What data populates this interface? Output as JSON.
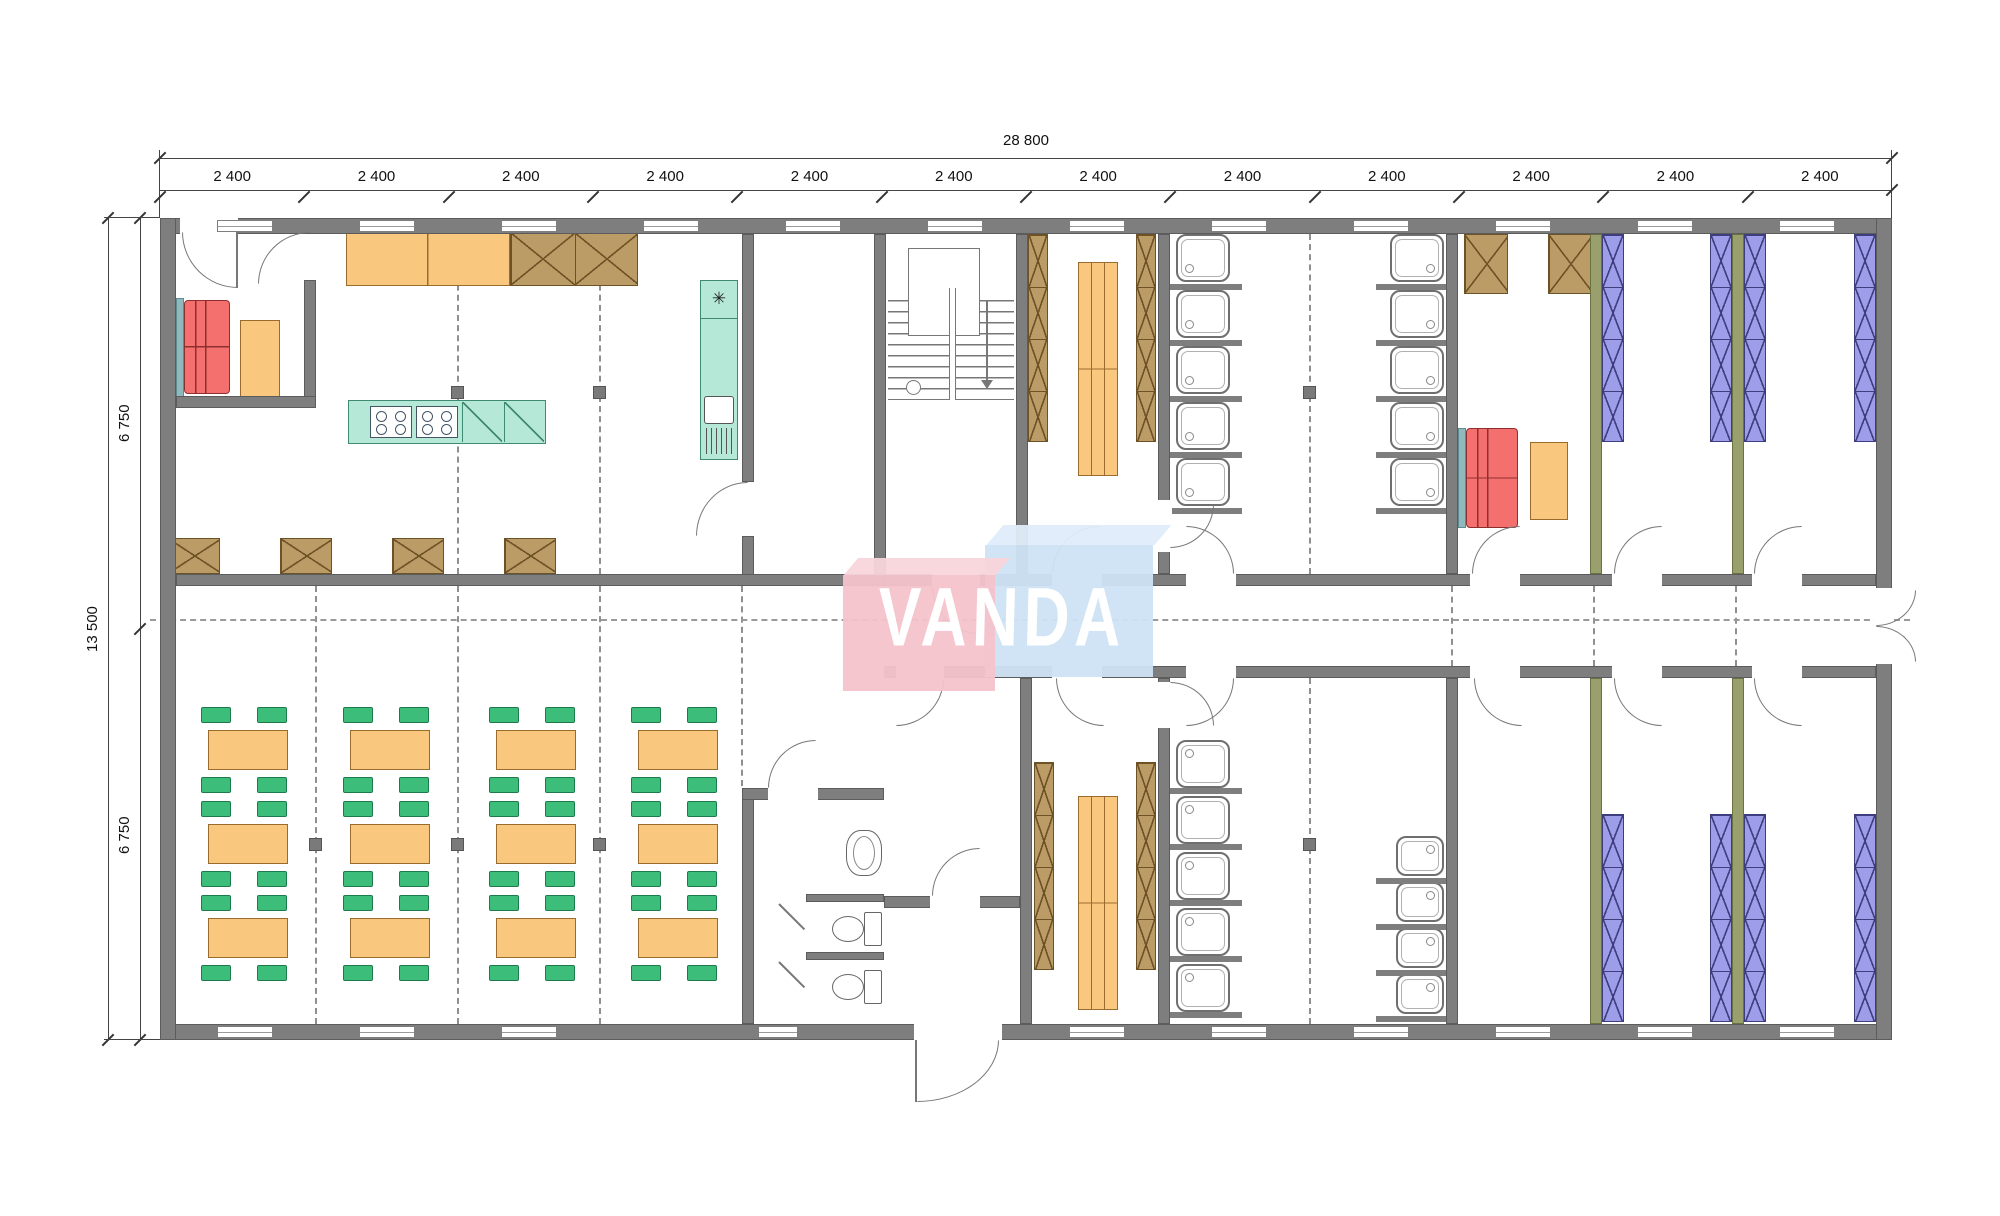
{
  "watermark": {
    "text": "VANDA"
  },
  "dimensions": {
    "top_total": "28 800",
    "top_segments": [
      "2 400",
      "2 400",
      "2 400",
      "2 400",
      "2 400",
      "2 400",
      "2 400",
      "2 400",
      "2 400",
      "2 400",
      "2 400",
      "2 400"
    ],
    "left_total": "13 500",
    "left_segments": [
      "6 750",
      "6 750"
    ]
  },
  "icons": {
    "snowflake": "✳"
  },
  "colors": {
    "wall": "#7e7e7e",
    "partition_olive": "#99a06d",
    "furniture_orange": "#f9c87e",
    "chair_green": "#3cbd79",
    "locker_brown": "#bb9b66",
    "bed_blue": "#9d9dea",
    "sofa_red": "#f4706f",
    "kitchen_teal": "#b5e8d6",
    "accent_teal": "#8fb9bd",
    "watermark_pink": "#f5c3cb",
    "watermark_blue": "#cfe3f5"
  },
  "fixtures": {
    "dining_tables": 12,
    "chairs_per_table": 4,
    "shower_stalls": 19,
    "toilets": 2,
    "washbasins": 1,
    "sofas": 2,
    "bunk_bed_columns": 8,
    "locker_columns": 10,
    "benches": 2,
    "stoves": 2,
    "fridges": 1,
    "stairs": 1
  }
}
